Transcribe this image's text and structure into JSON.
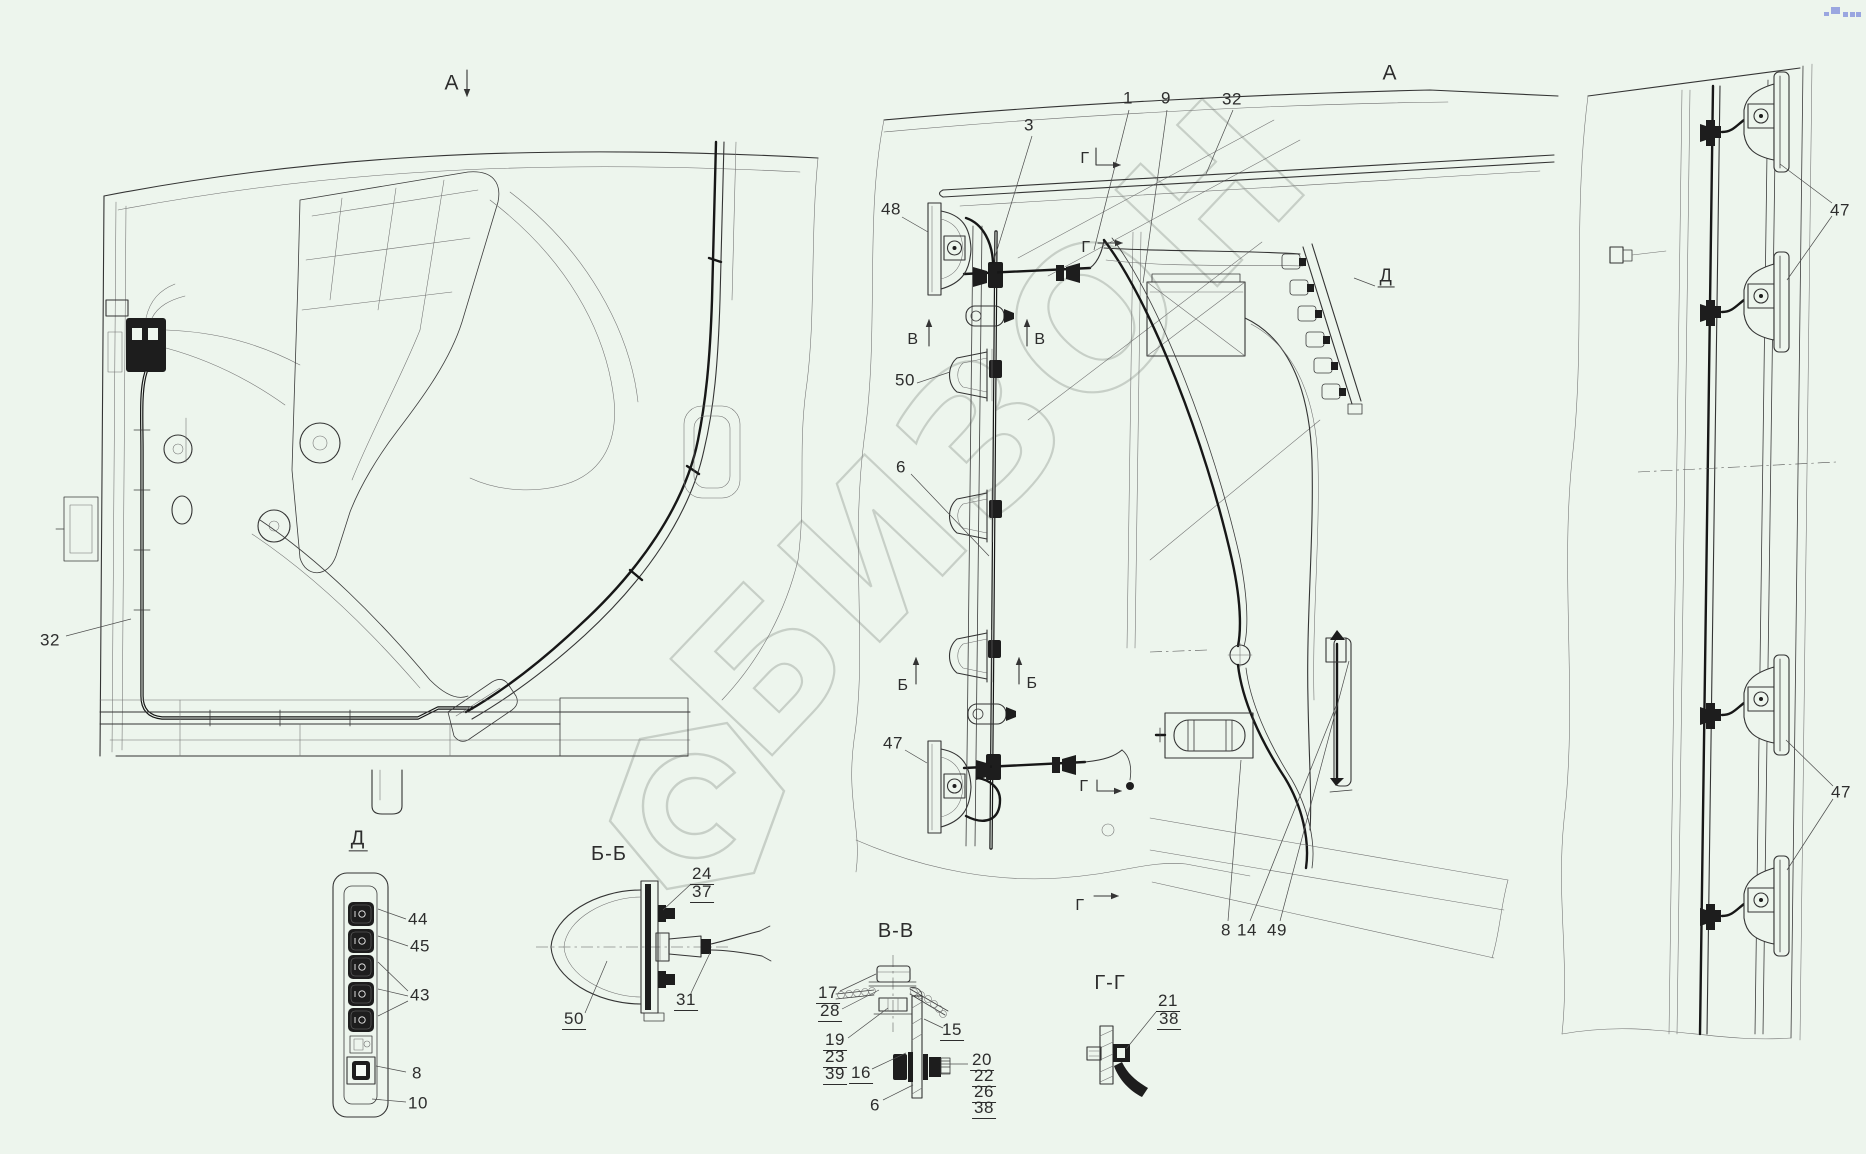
{
  "page": {
    "background_color": "#edf5ed",
    "line_color": "#343434",
    "watermark_color": "#c7cfc7",
    "corner_mark_color": "#9aa6e0"
  },
  "watermark": {
    "text": "БИЗОН",
    "logo": "hexagon-swirl-logo"
  },
  "labels": [
    {
      "name": "view-marker-a-left",
      "text": "А",
      "x": 452,
      "y": 84,
      "fs": 21
    },
    {
      "name": "view-title-a-right",
      "text": "А",
      "x": 1390,
      "y": 74,
      "fs": 21
    },
    {
      "name": "callout-3",
      "text": "3",
      "x": 1029,
      "y": 126
    },
    {
      "name": "callout-1",
      "text": "1",
      "x": 1128,
      "y": 99
    },
    {
      "name": "callout-9",
      "text": "9",
      "x": 1166,
      "y": 99
    },
    {
      "name": "callout-32-top",
      "text": "32",
      "x": 1232,
      "y": 100
    },
    {
      "name": "callout-48",
      "text": "48",
      "x": 891,
      "y": 210
    },
    {
      "name": "section-marker-g-1",
      "text": "Г",
      "x": 1085,
      "y": 160,
      "fs": 16
    },
    {
      "name": "section-marker-g-2",
      "text": "Г",
      "x": 1086,
      "y": 249,
      "fs": 16
    },
    {
      "name": "section-marker-v-left",
      "text": "В",
      "x": 913,
      "y": 341,
      "fs": 16
    },
    {
      "name": "section-marker-v-right",
      "text": "В",
      "x": 1040,
      "y": 341,
      "fs": 16
    },
    {
      "name": "callout-50",
      "text": "50",
      "x": 905,
      "y": 381
    },
    {
      "name": "callout-6",
      "text": "6",
      "x": 901,
      "y": 468
    },
    {
      "name": "callout-32-left",
      "text": "32",
      "x": 50,
      "y": 641
    },
    {
      "name": "section-marker-b-left",
      "text": "Б",
      "x": 903,
      "y": 687,
      "fs": 16
    },
    {
      "name": "section-marker-b-right",
      "text": "Б",
      "x": 1032,
      "y": 685,
      "fs": 16
    },
    {
      "name": "callout-47-center",
      "text": "47",
      "x": 893,
      "y": 744
    },
    {
      "name": "section-marker-g-3",
      "text": "Г",
      "x": 1084,
      "y": 788,
      "fs": 16
    },
    {
      "name": "section-marker-g-4",
      "text": "Г",
      "x": 1080,
      "y": 907,
      "fs": 16
    },
    {
      "name": "callout-8-main",
      "text": "8",
      "x": 1226,
      "y": 931
    },
    {
      "name": "callout-14",
      "text": "14",
      "x": 1247,
      "y": 931
    },
    {
      "name": "callout-49",
      "text": "49",
      "x": 1277,
      "y": 931
    },
    {
      "name": "callout-47-right-top",
      "text": "47",
      "x": 1840,
      "y": 211
    },
    {
      "name": "callout-47-right-bottom",
      "text": "47",
      "x": 1841,
      "y": 793
    },
    {
      "name": "label-d-connector",
      "text": "Д",
      "x": 1386,
      "y": 278,
      "fs": 18,
      "u": true
    },
    {
      "name": "panel-title-d",
      "text": "Д",
      "x": 358,
      "y": 841,
      "fs": 20,
      "u": true
    },
    {
      "name": "callout-44",
      "text": "44",
      "x": 418,
      "y": 920
    },
    {
      "name": "callout-45",
      "text": "45",
      "x": 420,
      "y": 947
    },
    {
      "name": "callout-43",
      "text": "43",
      "x": 420,
      "y": 996
    },
    {
      "name": "callout-8-panel",
      "text": "8",
      "x": 417,
      "y": 1074
    },
    {
      "name": "callout-10",
      "text": "10",
      "x": 418,
      "y": 1104
    },
    {
      "name": "section-title-bb",
      "text": "Б-Б",
      "x": 609,
      "y": 855,
      "fs": 20
    },
    {
      "name": "callout-24",
      "text": "24",
      "x": 702,
      "y": 876,
      "u": true
    },
    {
      "name": "callout-37",
      "text": "37",
      "x": 702,
      "y": 894,
      "u": true
    },
    {
      "name": "callout-50-bb",
      "text": "50",
      "x": 574,
      "y": 1021,
      "u": true
    },
    {
      "name": "callout-31",
      "text": "31",
      "x": 686,
      "y": 1002,
      "u": true
    },
    {
      "name": "section-title-vv",
      "text": "В-В",
      "x": 896,
      "y": 932,
      "fs": 20
    },
    {
      "name": "callout-17",
      "text": "17",
      "x": 828,
      "y": 995,
      "u": true
    },
    {
      "name": "callout-28",
      "text": "28",
      "x": 830,
      "y": 1013,
      "u": true
    },
    {
      "name": "callout-19",
      "text": "19",
      "x": 835,
      "y": 1042,
      "u": true
    },
    {
      "name": "callout-23",
      "text": "23",
      "x": 835,
      "y": 1059,
      "u": true
    },
    {
      "name": "callout-39",
      "text": "39",
      "x": 835,
      "y": 1076,
      "u": true
    },
    {
      "name": "callout-16",
      "text": "16",
      "x": 861,
      "y": 1075,
      "u": true
    },
    {
      "name": "callout-6-vv",
      "text": "6",
      "x": 875,
      "y": 1106
    },
    {
      "name": "callout-15",
      "text": "15",
      "x": 952,
      "y": 1032,
      "u": true
    },
    {
      "name": "callout-20",
      "text": "20",
      "x": 982,
      "y": 1062,
      "u": true
    },
    {
      "name": "callout-22",
      "text": "22",
      "x": 984,
      "y": 1078,
      "u": true
    },
    {
      "name": "callout-26",
      "text": "26",
      "x": 984,
      "y": 1094,
      "u": true
    },
    {
      "name": "callout-38-vv",
      "text": "38",
      "x": 984,
      "y": 1110,
      "u": true
    },
    {
      "name": "section-title-gg",
      "text": "Г-Г",
      "x": 1110,
      "y": 984,
      "fs": 20
    },
    {
      "name": "callout-21",
      "text": "21",
      "x": 1168,
      "y": 1003,
      "u": true
    },
    {
      "name": "callout-38-gg",
      "text": "38",
      "x": 1169,
      "y": 1021,
      "u": true
    }
  ]
}
